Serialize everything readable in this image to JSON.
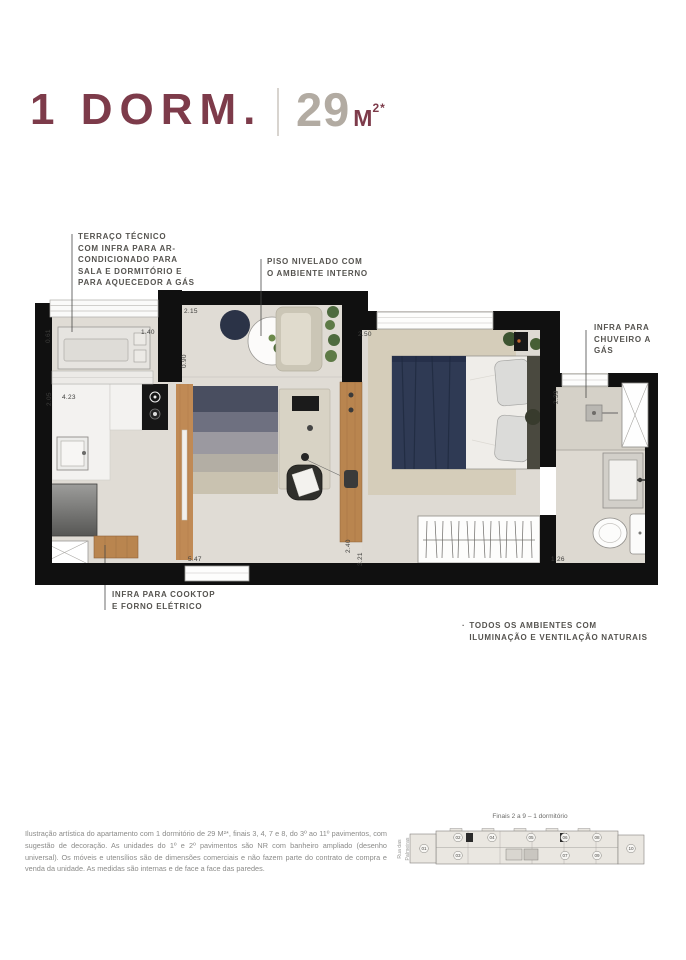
{
  "header": {
    "title": "1 DORM.",
    "area_value": "29",
    "area_unit": "M",
    "area_sup": "2*"
  },
  "plan": {
    "dims": {
      "terrace_depth": "0.61",
      "terrace_width": "1.40",
      "entry_width": "2.15",
      "entry_depth": "0.90",
      "bedroom_width": "2.50",
      "bathroom_depth": "2.39",
      "kitchen_depth": "2.05",
      "kitchen_width": "4.23",
      "living_length": "5.47",
      "counter_length": "2.40",
      "bedroom_length": "3.21",
      "bathroom_width": "1.26"
    },
    "notes": {
      "terrace": "TERRAÇO TÉCNICO\nCOM INFRA PARA AR-\nCONDICIONADO PARA\nSALA E DORMITÓRIO E\nPARA AQUECEDOR A GÁS",
      "piso": "PISO NIVELADO COM\nO AMBIENTE INTERNO",
      "chuveiro": "INFRA PARA\nCHUVEIRO A\nGÁS",
      "cooktop": "INFRA PARA COOKTOP\nE FORNO ELÉTRICO"
    },
    "bullet_note": {
      "bullet": "·",
      "text": "TODOS OS AMBIENTES COM\nILUMINAÇÃO E VENTILAÇÃO NATURAIS"
    }
  },
  "keyplan": {
    "caption": "Finais 2 a 9 – 1 dormitório",
    "street_lines": [
      "Rua das",
      "Palmeiras"
    ],
    "units": [
      "01",
      "02",
      "03",
      "04",
      "05",
      "06",
      "07",
      "08",
      "09",
      "10"
    ]
  },
  "footer": {
    "disclaimer": "Ilustração artística do apartamento com 1 dormitório de 29 M²*, finais 3, 4, 7 e 8, do 3º ao 11º pavimentos, com sugestão de decoração. As unidades do 1º e 2º pavimentos são NR com banheiro ampliado (desenho universal). Os móveis e utensílios são de dimensões comerciais e não fazem parte do contrato de compra e venda da unidade. As medidas são internas e de face a face das paredes."
  },
  "colors": {
    "brand_maroon": "#7d3b4a",
    "area_gray": "#b2aba2",
    "wall_black": "#101010",
    "floor_beige": "#dedad3",
    "wood": "#c08a55",
    "bed_navy": "#2f3a54"
  }
}
